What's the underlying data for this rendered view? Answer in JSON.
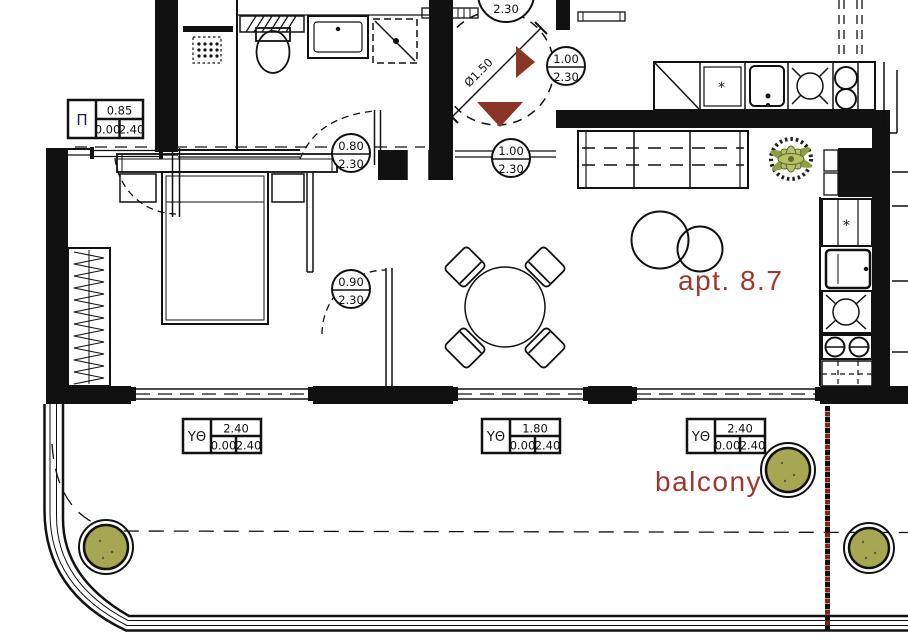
{
  "plan": {
    "apartment_label": "apt. 8.7",
    "balcony_label": "balcony",
    "turning_circle_label": "Ø1.50",
    "fridge_symbol": "*",
    "window_schedule_box": {
      "symbol": "Π",
      "width": "0.85",
      "sill": "0.00",
      "height": "2.40"
    },
    "door_labels": {
      "top_door": {
        "bottom": "2.30"
      },
      "entry_right": {
        "top": "1.00",
        "bottom": "2.30"
      },
      "bathroom": {
        "top": "0.80",
        "bottom": "2.30"
      },
      "hall_passage": {
        "top": "1.00",
        "bottom": "2.30"
      },
      "bedroom": {
        "top": "0.90",
        "bottom": "2.30"
      }
    },
    "balcony_openings": [
      {
        "symbol": "ΥΘ",
        "width": "2.40",
        "sill": "0.00",
        "height": "2.40"
      },
      {
        "symbol": "ΥΘ",
        "width": "1.80",
        "sill": "0.00",
        "height": "2.40"
      },
      {
        "symbol": "ΥΘ",
        "width": "2.40",
        "sill": "0.00",
        "height": "2.40"
      }
    ],
    "colors": {
      "accent_text": "#a1362f",
      "entry_arrow": "#8a3526",
      "plant_fill": "#a6a653",
      "red_dotted": "#7c241c",
      "wall": "#111111"
    }
  }
}
